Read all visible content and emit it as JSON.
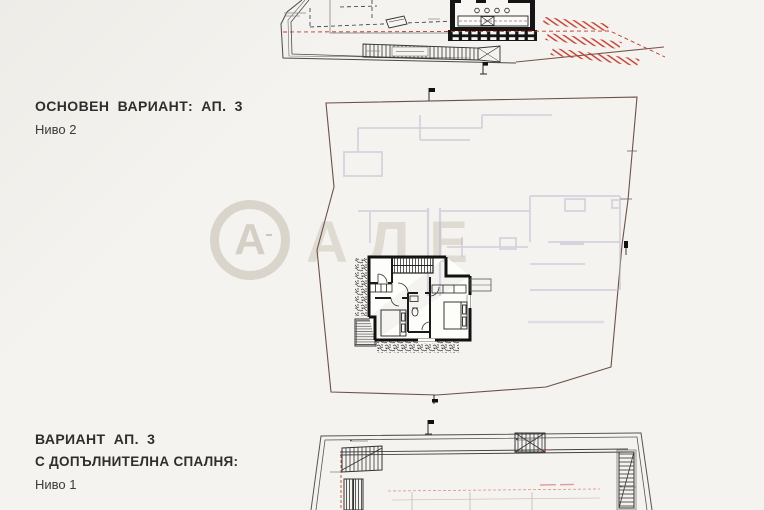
{
  "background": "#f4f3ef",
  "sections": [
    {
      "title": "ОСНОВЕН ВАРИАНТ: АП. 3",
      "subtitle": "Ниво 2"
    },
    {
      "title": "ВАРИАНТ АП. 3",
      "line2": "С ДОПЪЛНИТЕЛНА СПАЛНЯ:",
      "subtitle": "Ниво 1"
    }
  ],
  "watermark": {
    "monogram": "А",
    "letters": "АЛЕ"
  },
  "plans": [
    {
      "name": "level-2-roof-plan"
    },
    {
      "name": "site-plan-with-apartment"
    },
    {
      "name": "level-1-plan"
    }
  ],
  "colors": {
    "paper": "#f4f3ef",
    "wall_black": "#1a1a1a",
    "roof_outline_red": "#c0392b",
    "boundary_brown": "#6d5148",
    "ghost_walls": "#bdb9cf"
  }
}
